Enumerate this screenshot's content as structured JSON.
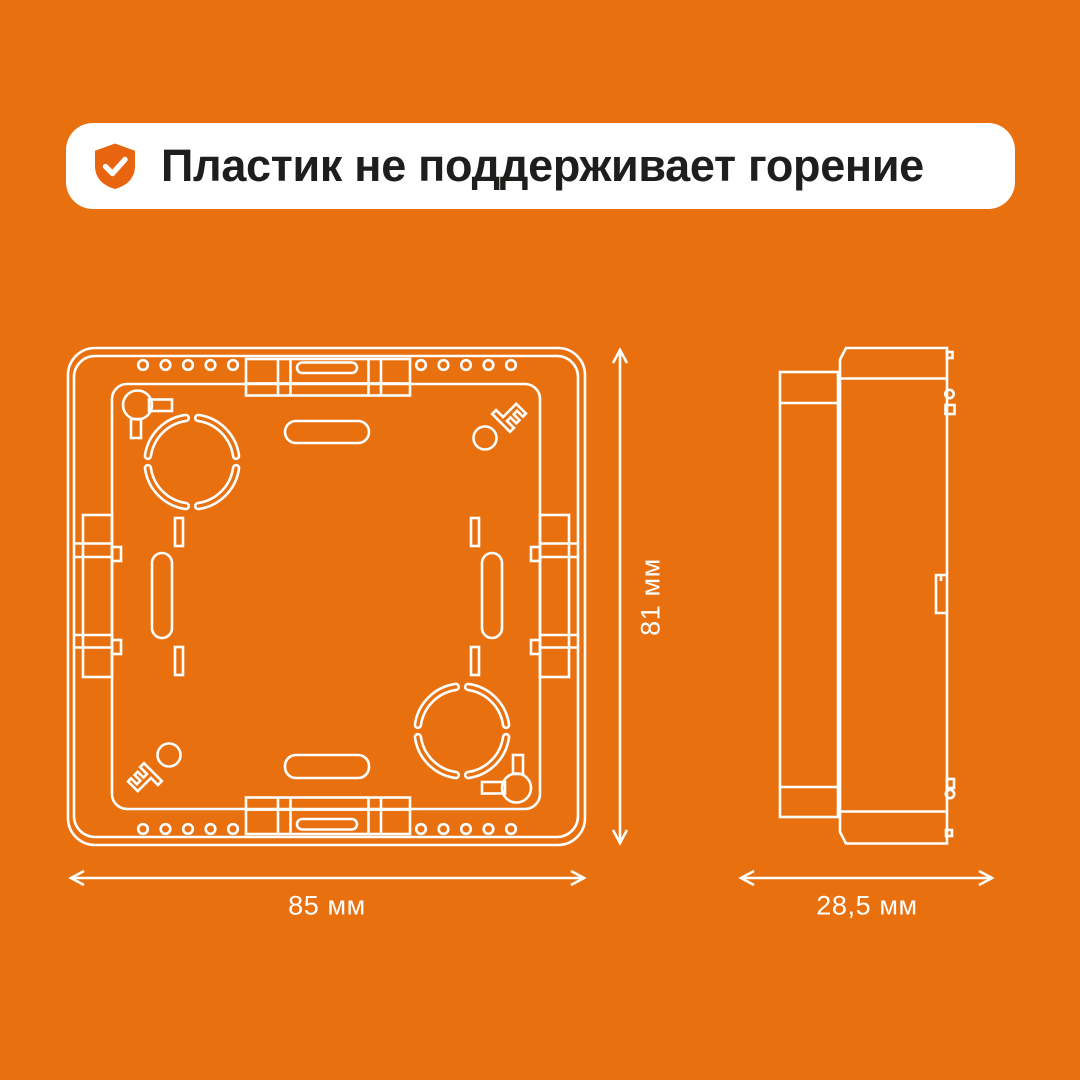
{
  "banner": {
    "text": "Пластик не поддерживает горение",
    "icon": "shield-check"
  },
  "dimensions": {
    "width": "85 мм",
    "height": "81 мм",
    "depth": "28,5 мм"
  },
  "colors": {
    "background": "#E8700E",
    "line": "#FFFFFF",
    "banner_bg": "#FFFFFF",
    "banner_text": "#1E1E1C",
    "shield": "#E8640E"
  }
}
